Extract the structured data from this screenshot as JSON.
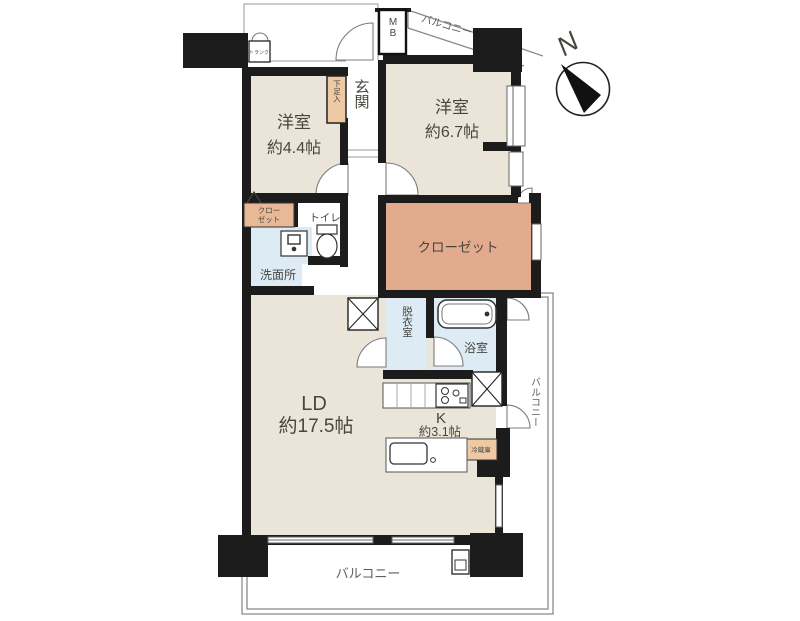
{
  "plan_title": "apartment-floor-plan",
  "rooms": {
    "west1": {
      "name": "洋室",
      "area": "約4.4帖"
    },
    "west2": {
      "name": "洋室",
      "area": "約6.7帖"
    },
    "living": {
      "name": "LD",
      "area": "約17.5帖"
    },
    "kitchen": {
      "name": "K",
      "area": "約3.1帖"
    }
  },
  "labels": {
    "entrance": "玄関",
    "walkin_closet": "クローゼット",
    "closet_l1": "クロー",
    "closet_l2": "ゼット",
    "toilet": "トイレ",
    "washroom": "洗面所",
    "dressing": "脱衣室",
    "bath": "浴室",
    "shoe_cabinet": "下足入",
    "trunk": "トランク",
    "meter_box": "MB",
    "fridge": "冷蔵庫",
    "balcony": "バルコニー",
    "compass_north": "N"
  },
  "colors": {
    "room_beige": "#eae5d8",
    "closet_salmon": "#e2ab8d",
    "cabinet_tan": "#eecaa4",
    "wet_blue": "#dcebf4",
    "wall_black": "#1c1c1c",
    "rail_gray": "#8a8a8a"
  }
}
